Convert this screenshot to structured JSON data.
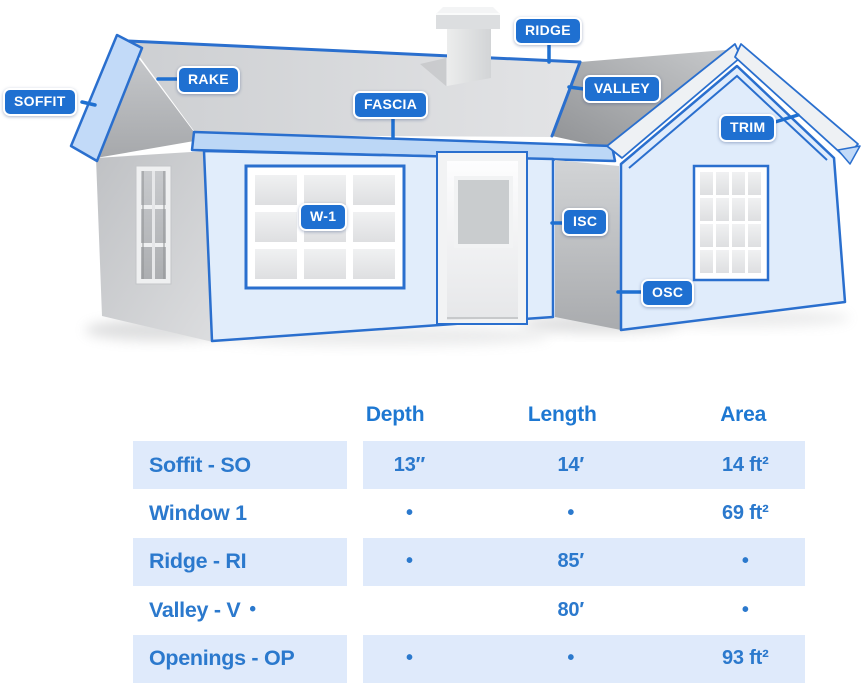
{
  "diagram": {
    "callouts": [
      {
        "id": "soffit",
        "label": "SOFFIT"
      },
      {
        "id": "rake",
        "label": "RAKE"
      },
      {
        "id": "fascia",
        "label": "FASCIA"
      },
      {
        "id": "ridge",
        "label": "RIDGE"
      },
      {
        "id": "valley",
        "label": "VALLEY"
      },
      {
        "id": "trim",
        "label": "TRIM"
      },
      {
        "id": "w1",
        "label": "W-1"
      },
      {
        "id": "isc",
        "label": "ISC"
      },
      {
        "id": "osc",
        "label": "OSC"
      }
    ]
  },
  "table": {
    "headers": {
      "depth": "Depth",
      "length": "Length",
      "area": "Area"
    },
    "rows": [
      {
        "label": "Soffit - SO",
        "depth": "13″",
        "length": "14′",
        "area": "14 ft²"
      },
      {
        "label": "Window 1",
        "depth": "•",
        "length": "•",
        "area": "69 ft²"
      },
      {
        "label": "Ridge - RI",
        "depth": "•",
        "length": "85′",
        "area": "•"
      },
      {
        "label": "Valley - V",
        "dot": "•",
        "depth": "",
        "length": "80′",
        "area": "•"
      },
      {
        "label": "Openings - OP",
        "depth": "•",
        "length": "•",
        "area": "93 ft²"
      }
    ]
  },
  "colors": {
    "accent_blue": "#1f70d1",
    "outline_blue": "#2a6fce",
    "wall_blue": "#e1edfb",
    "band_blue": "#bcd7f6",
    "roof_gray": "#d7d8da",
    "row_bg": "#dfeafb",
    "table_text": "#2b79cd"
  }
}
